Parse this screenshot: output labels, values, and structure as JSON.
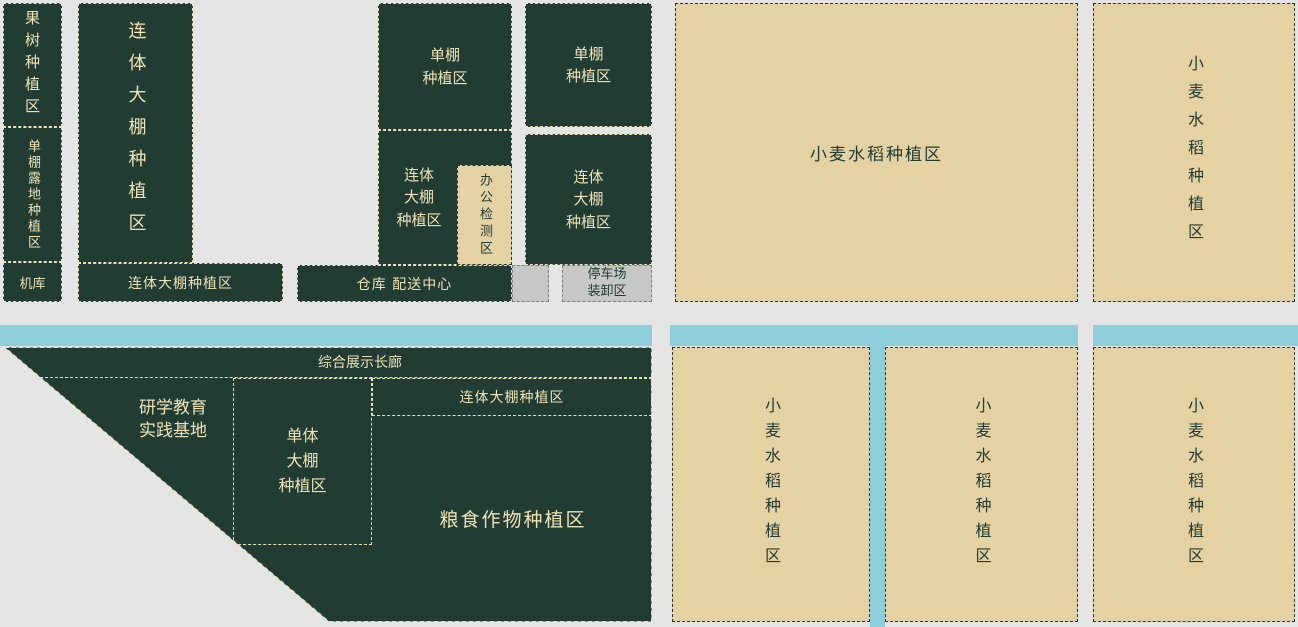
{
  "plan": {
    "type": "farm-campus-site-plan",
    "colors": {
      "zone_dark_green": "#203c33",
      "zone_tan": "#e5d2a3",
      "water_road_blue": "#8ccfdb",
      "service_gray": "#c7c7c7",
      "background_gray": "#e5e5e5",
      "cream_text_border": "#efe2b4"
    },
    "zones": {
      "orchard": {
        "label": "果树种植区"
      },
      "single_shed_open_field": {
        "label": "单棚露地种植区"
      },
      "hangar": {
        "label": "机库"
      },
      "joint_greenhouse_tall": {
        "label": "连体大棚种植区"
      },
      "joint_greenhouse_strip": {
        "label": "连体大棚种植区"
      },
      "single_shed_mid": {
        "label": "单棚\n种植区"
      },
      "joint_greenhouse_mid": {
        "label": "连体\n大棚\n种植区"
      },
      "office_inspection": {
        "label": "办公检测区"
      },
      "warehouse_distribution": {
        "label": "仓库 配送中心"
      },
      "parking_unloading": {
        "label": "停车场\n装卸区"
      },
      "single_shed_right": {
        "label": "单棚\n种植区"
      },
      "joint_greenhouse_right": {
        "label": "连体\n大棚\n种植区"
      },
      "wheat_rice_large": {
        "label": "小麦水稻种植区"
      },
      "wheat_rice_northeast": {
        "label": "小麦水稻种植区"
      },
      "exhibition_corridor": {
        "label": "综合展示长廊"
      },
      "edu_practice_base": {
        "label": "研学教育\n实践基地"
      },
      "single_greenhouse": {
        "label": "单体\n大棚\n种植区"
      },
      "joint_greenhouse_south": {
        "label": "连体大棚种植区"
      },
      "grain_crops": {
        "label": "粮食作物种植区"
      },
      "wheat_rice_south_1": {
        "label": "小麦水稻种植区"
      },
      "wheat_rice_south_2": {
        "label": "小麦水稻种植区"
      },
      "wheat_rice_south_3": {
        "label": "小麦水稻种植区"
      }
    }
  }
}
